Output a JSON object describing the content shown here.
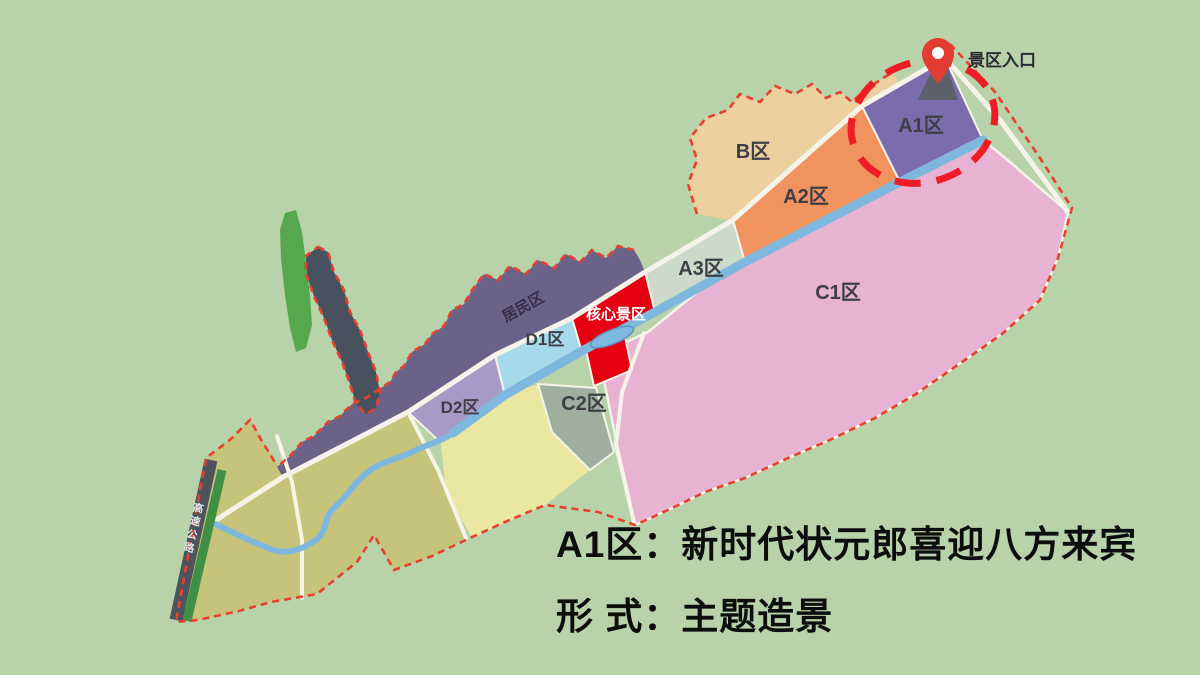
{
  "title_caption": {
    "line1": "A1区：新时代状元郎喜迎八方来宾",
    "line2": "形 式：主题造景",
    "color": "#0d0d0d"
  },
  "entrance": {
    "label": "景区入口",
    "pin_color": "#e23b30",
    "gate_color": "#5b6069",
    "label_color": "#2b2b31"
  },
  "highlight_ellipse": {
    "color": "#ee1c24"
  },
  "zones": [
    {
      "id": "A1",
      "label": "A1区",
      "color": "#7b6dad"
    },
    {
      "id": "A2",
      "label": "A2区",
      "color": "#f0935f"
    },
    {
      "id": "A3",
      "label": "A3区",
      "color": "#cdd9cb"
    },
    {
      "id": "B",
      "label": "B区",
      "color": "#ecd0a0"
    },
    {
      "id": "C1",
      "label": "C1区",
      "color": "#e8b2d2"
    },
    {
      "id": "C2",
      "label": "C2区",
      "color": "#9fae9e"
    },
    {
      "id": "D1",
      "label": "D1区",
      "color": "#a6d9ea"
    },
    {
      "id": "D2",
      "label": "D2区",
      "color": "#a79ac6"
    },
    {
      "id": "core",
      "label": "核心景区",
      "color": "#e60012",
      "text_color": "#ffffff"
    },
    {
      "id": "residential",
      "label": "居民区",
      "color": "#6b6387",
      "text_color": "#362f4a"
    }
  ],
  "land": {
    "pale_yellow": "#eae7a0",
    "olive": "#c6c47b"
  },
  "features": {
    "forest_strip": "#57a74e",
    "hill": "#47525e"
  },
  "map": {
    "background": "#b8d2a9",
    "road": "#f6f4e9",
    "river": "#7fb8df",
    "boundary_dash": "#e8402f",
    "highway": "#4d545b",
    "highway_edge": "#3f9045",
    "zone_label_color": "#3e3e47",
    "highway_label": "高速公路",
    "highway_label_color": "#e3e6e8"
  }
}
